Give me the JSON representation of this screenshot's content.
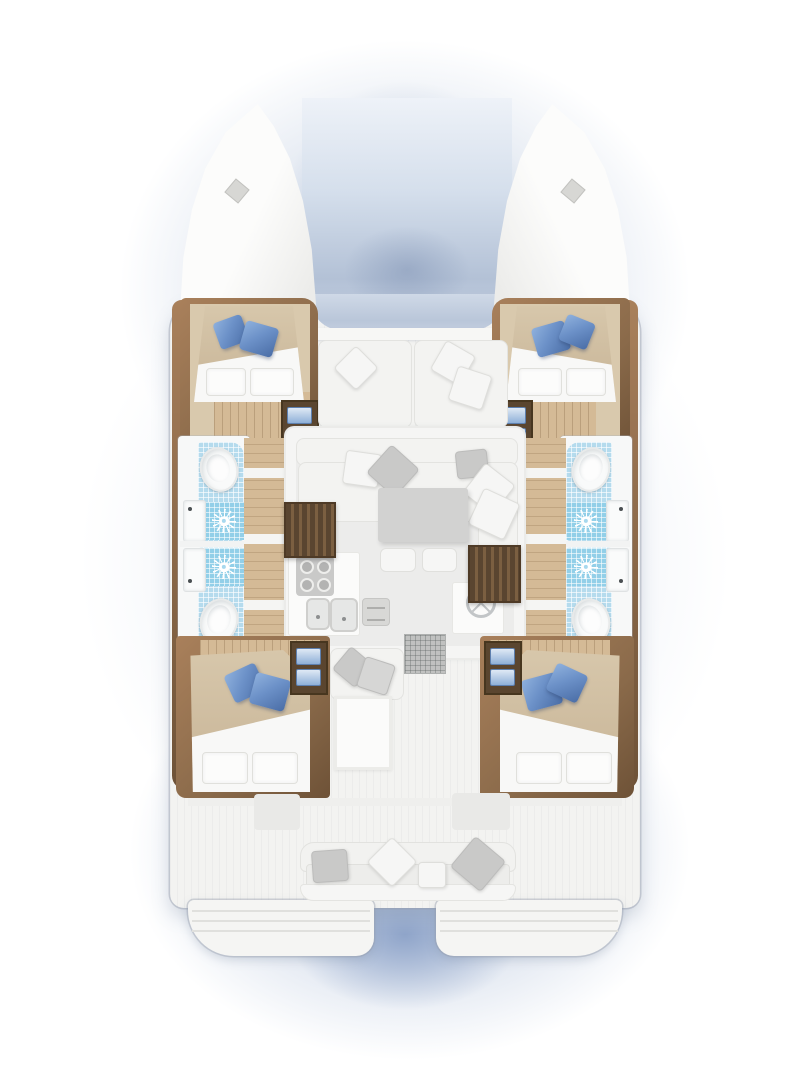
{
  "diagram": {
    "type": "floor-plan",
    "subject": "catamaran-yacht-interior-layout",
    "view": "overhead-cutaway",
    "features": {
      "cabins": [
        "forward-port",
        "forward-starboard",
        "aft-port",
        "aft-starboard"
      ],
      "cabin_contents": [
        "double-bed",
        "blue-throw-pillows",
        "white-pillows",
        "steps-with-blue-treads",
        "wood-floor"
      ],
      "bathrooms": [
        "port-forward",
        "port-aft",
        "starboard-forward",
        "starboard-aft"
      ],
      "bathroom_contents": [
        "toilet",
        "sink",
        "shower-with-drain-rose",
        "blue-tile-floor"
      ],
      "saloon": [
        "u-shaped-sofa",
        "coffee-table",
        "stools",
        "galley-cooktop",
        "galley-double-sink",
        "oven",
        "nav-station-wheel",
        "companionway-stairs-port",
        "companionway-stairs-starboard",
        "entry-mat"
      ],
      "decks": [
        "twin-bows",
        "bow-hatches",
        "trampoline-gap",
        "forward-cockpit-benches",
        "aft-cockpit-bench",
        "cockpit-side-seats",
        "transom-steps-port",
        "transom-steps-starboard"
      ]
    }
  },
  "palette": {
    "pageBg": "#ffffff",
    "deck": "#f3f3f1",
    "wood": "#8a6a4a",
    "woodDark": "#6e5237",
    "woodLight": "#a9805b",
    "floorWood": "#d4ba96",
    "cabinFloor": "#d9c9ad",
    "bedTan": "#cdbb9e",
    "bedWhite": "#f8f8f7",
    "pillowBlue": "#6c91c8",
    "pillowBlueDark": "#4a6da6",
    "pillowBlueLight": "#8fb1dd",
    "pillowGray": "#c9c9c8",
    "sofa": "#f3f3f1",
    "table": "#d2d2d1",
    "tile": "#b5dbed",
    "tileShower": "#92cfe8",
    "fixture": "#f9fafa",
    "stairDark": "#5a4530",
    "stairLight": "#7b5f41",
    "tramp1": "#cfd9e7",
    "tramp2": "#b9c6d9"
  }
}
